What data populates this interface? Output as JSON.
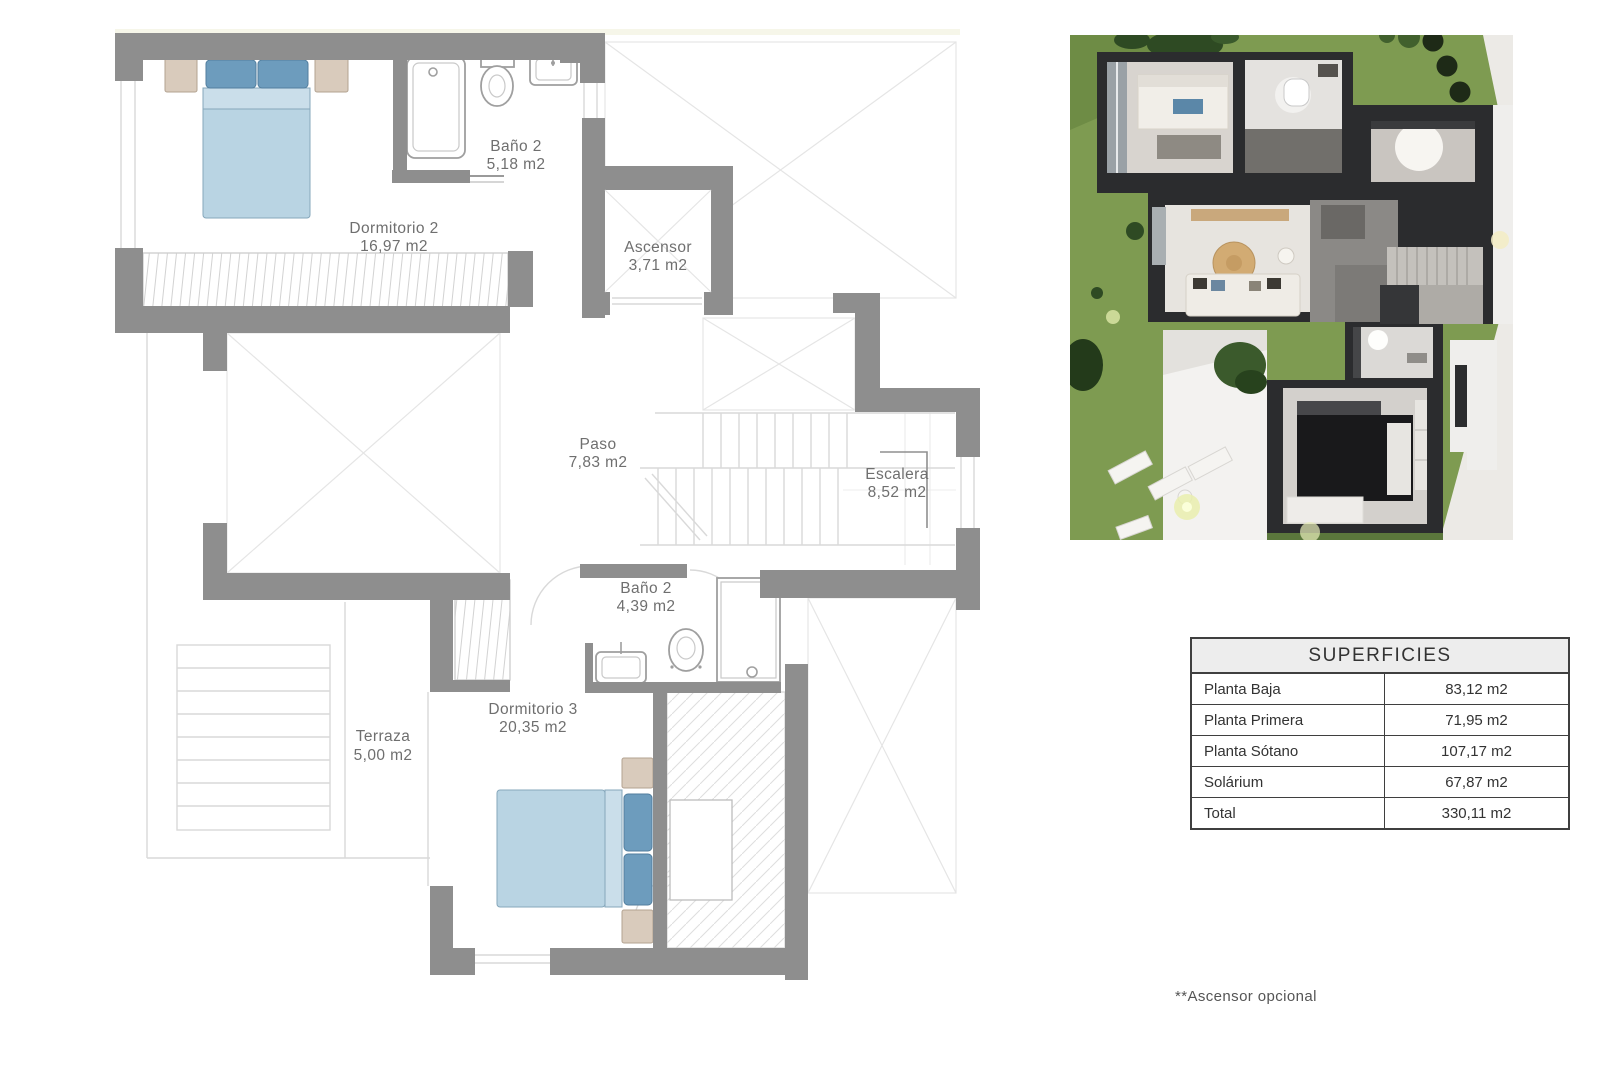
{
  "floor_plan": {
    "rooms": [
      {
        "name": "Baño 2",
        "area": "5,18 m2"
      },
      {
        "name": "Dormitorio 2",
        "area": "16,97 m2"
      },
      {
        "name": "Ascensor",
        "area": "3,71 m2"
      },
      {
        "name": "Paso",
        "area": "7,83 m2"
      },
      {
        "name": "Escalera",
        "area": "8,52 m2"
      },
      {
        "name": "Baño 2",
        "area": "4,39 m2"
      },
      {
        "name": "Dormitorio 3",
        "area": "20,35 m2"
      },
      {
        "name": "Terraza",
        "area": "5,00 m2"
      }
    ],
    "colors": {
      "wall": "#8e8e8e",
      "thin_line": "#d9d9d9",
      "bed": "#b9d4e3",
      "pillow": "#6d9cbd",
      "nightstand": "#d9cbbc",
      "label_text": "#6f6f6f"
    }
  },
  "surfaces_table": {
    "title": "SUPERFICIES",
    "rows": [
      {
        "label": "Planta Baja",
        "value": "83,12 m2"
      },
      {
        "label": "Planta Primera",
        "value": "71,95 m2"
      },
      {
        "label": "Planta Sótano",
        "value": "107,17 m2"
      },
      {
        "label": "Solárium",
        "value": "67,87 m2"
      },
      {
        "label": "Total",
        "value": "330,11 m2"
      }
    ]
  },
  "footnote": "**Ascensor opcional",
  "render_3d": {
    "colors": {
      "grass": "#7e9b51",
      "house": "#2b2c2e",
      "path": "#eceae6"
    }
  }
}
